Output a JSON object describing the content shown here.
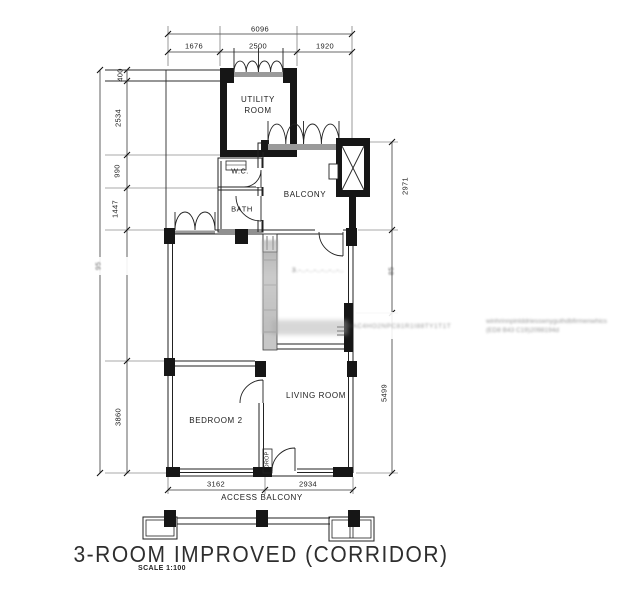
{
  "title": {
    "main": "3-ROOM IMPROVED (CORRIDOR)",
    "scale": "SCALE  1:100"
  },
  "dimensions": {
    "top_total": "6096",
    "top": [
      "1676",
      "2500",
      "1920"
    ],
    "left": [
      "400",
      "2534",
      "990",
      "1447",
      "3860"
    ],
    "left_total_garbled": "95",
    "right": [
      "2971",
      "85",
      "5499"
    ],
    "bottom": [
      "3162",
      "2934"
    ]
  },
  "rooms": {
    "utility_line1": "UTILITY",
    "utility_line2": "ROOM",
    "wc": "W.C.",
    "bath": "BATH",
    "balcony": "BALCONY",
    "bedroom1_blurred": "3.-..-..-..-..-..-..",
    "bedroom2": "BEDROOM 2",
    "living": "LIVING ROOM",
    "drop": "DROP",
    "access_balcony": "ACCESS  BALCONY"
  },
  "watermarks": {
    "band_mid": "WAC4HO2NPC81R1I88TY1T1T",
    "right_line1": "winhrinnpinlddriesswnyguthdbfirmenwhics",
    "right_line2": "(ED8 B43 C19)2098194d"
  },
  "colors": {
    "wall": "#161616",
    "line": "#333333",
    "sill": "#9a9a9a",
    "smudge": "#b9b9b9"
  }
}
